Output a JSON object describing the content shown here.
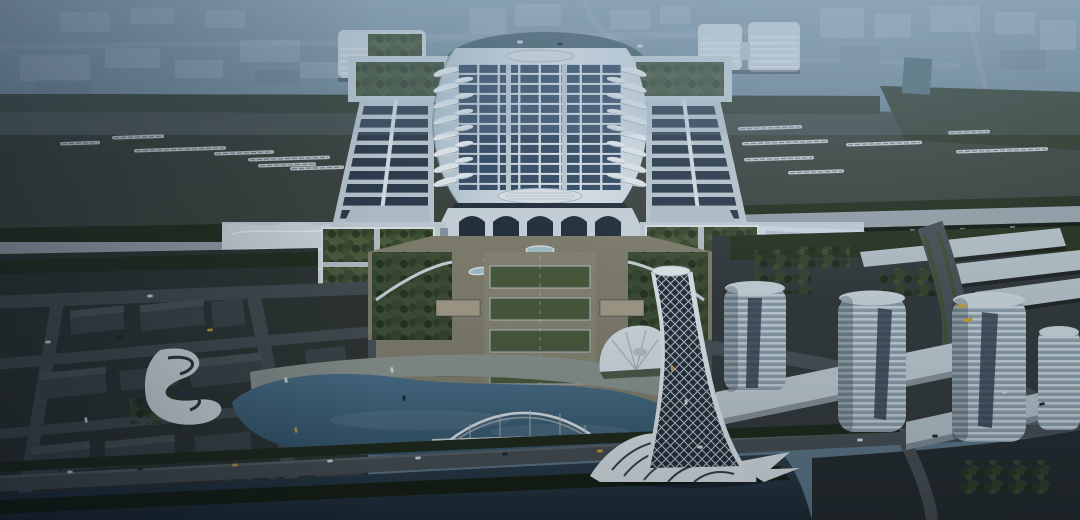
{
  "scene": {
    "title": "Aerial dusk rendering of a high-speed railway station complex",
    "time_of_day": "dusk",
    "description": "Bird's-eye architectural rendering: a huge white station hall with a solar-panel roof flanked by platform canopies and rail yards with white trains; a landscaped axial plaza leads south to a lake with an arched gateway bridge, a twisted white lattice tower, cylindrical towers on podiums to the southeast, low dark city blocks to the southwest, and a hazy city skyline to the north.",
    "landmarks": [
      "station-main-hall",
      "solar-panel-roof",
      "platform-canopies",
      "rail-yards",
      "west-annex",
      "east-annex",
      "axial-plaza",
      "lake",
      "arch-bridge",
      "twist-tower",
      "cylindrical-towers",
      "waterfront-road",
      "river"
    ]
  },
  "palette": {
    "sky_top": "#8fa6b4",
    "sky_low": "#617b8c",
    "rail_bed": "#3c433d",
    "train": "#c7ccd0",
    "viaduct": "#9aa5ac",
    "roof_light": "#e9eff4",
    "roof_mid": "#c6d3dc",
    "solar": "#344a63",
    "canopy_base": "#c2cdd5",
    "canopy_strip": "#2c3a4a",
    "skylight": "#edf2f5",
    "glass": "#232e38",
    "annex": "#c6d1d9",
    "annex_roof": "#d4dde4",
    "court_green": "#4d5d3b",
    "path_light": "#b9c3c9",
    "facade": "#9fabb2",
    "plaza": "#83806d",
    "lawn": "#4a5a3a",
    "garden": "#3f4e33",
    "beige": "#a9a18a",
    "road": "#474e53",
    "road_light": "#5a6166",
    "ground_left": "#2d332f",
    "block": "#3e4549",
    "block_top": "#4e5559",
    "lake_hi": "#4a7089",
    "lake_lo": "#35566b",
    "river_hi": "#2a3d4a",
    "river_lo": "#1c2a34",
    "promenade": "#8d968f",
    "white": "#e2e9ed",
    "tower_base": "#8fa1ad",
    "tower_top": "#cdd8df",
    "podium": "#c3ced5",
    "slab": "#b9c4ca",
    "tree_dark": "#27331f",
    "tree_mid": "#33402a",
    "car_white": "#d9dee1",
    "car_dark": "#20262c",
    "car_yellow": "#c9a23a"
  },
  "trains": [
    {
      "x": 60,
      "y": 142,
      "len": 40
    },
    {
      "x": 112,
      "y": 136,
      "len": 52
    },
    {
      "x": 134,
      "y": 149,
      "len": 92
    },
    {
      "x": 214,
      "y": 152,
      "len": 60
    },
    {
      "x": 248,
      "y": 158,
      "len": 82
    },
    {
      "x": 258,
      "y": 164,
      "len": 58
    },
    {
      "x": 290,
      "y": 167,
      "len": 54
    },
    {
      "x": 738,
      "y": 127,
      "len": 64
    },
    {
      "x": 742,
      "y": 142,
      "len": 86
    },
    {
      "x": 846,
      "y": 143,
      "len": 76
    },
    {
      "x": 948,
      "y": 131,
      "len": 42
    },
    {
      "x": 956,
      "y": 150,
      "len": 92
    },
    {
      "x": 744,
      "y": 158,
      "len": 70
    },
    {
      "x": 788,
      "y": 171,
      "len": 56
    }
  ],
  "station": {
    "skylights": [
      {
        "x": 446,
        "rot": -15,
        "s": 1.0,
        "ys": [
          72,
          88,
          104,
          120,
          136,
          152,
          168,
          182
        ]
      },
      {
        "x": 634,
        "rot": 15,
        "s": 1.0,
        "ys": [
          72,
          88,
          104,
          120,
          136,
          152,
          168,
          182
        ]
      },
      {
        "x": 464,
        "rot": -10,
        "s": 0.72,
        "ys": [
          80,
          96,
          112,
          128,
          144,
          160,
          176
        ]
      },
      {
        "x": 616,
        "rot": 10,
        "s": 0.72,
        "ys": [
          80,
          96,
          112,
          128,
          144,
          160,
          176
        ]
      }
    ]
  },
  "cars": [
    {
      "x": 70,
      "y": 472,
      "r": -3,
      "c": "car_white"
    },
    {
      "x": 140,
      "y": 469,
      "r": -3,
      "c": "car_dark"
    },
    {
      "x": 235,
      "y": 465,
      "r": -3,
      "c": "car_yellow"
    },
    {
      "x": 330,
      "y": 461,
      "r": -3,
      "c": "car_white"
    },
    {
      "x": 418,
      "y": 458,
      "r": -3,
      "c": "car_white"
    },
    {
      "x": 505,
      "y": 454,
      "r": -3,
      "c": "car_dark"
    },
    {
      "x": 600,
      "y": 451,
      "r": -2,
      "c": "car_yellow"
    },
    {
      "x": 700,
      "y": 447,
      "r": -2,
      "c": "car_white"
    },
    {
      "x": 860,
      "y": 440,
      "r": -2,
      "c": "car_white"
    },
    {
      "x": 935,
      "y": 436,
      "r": -2,
      "c": "car_dark"
    },
    {
      "x": 962,
      "y": 306,
      "r": -8,
      "c": "car_yellow",
      "bus": true
    },
    {
      "x": 968,
      "y": 320,
      "r": -8,
      "c": "car_yellow",
      "bus": true
    },
    {
      "x": 1005,
      "y": 392,
      "r": -15,
      "c": "car_white"
    },
    {
      "x": 1042,
      "y": 404,
      "r": -15,
      "c": "car_dark"
    },
    {
      "x": 48,
      "y": 342,
      "r": -5,
      "c": "car_white"
    },
    {
      "x": 120,
      "y": 337,
      "r": -5,
      "c": "car_dark"
    },
    {
      "x": 210,
      "y": 330,
      "r": -5,
      "c": "car_yellow"
    },
    {
      "x": 150,
      "y": 296,
      "r": -5,
      "c": "car_white"
    },
    {
      "x": 86,
      "y": 420,
      "r": 82,
      "c": "car_white"
    },
    {
      "x": 60,
      "y": 468,
      "r": 82,
      "c": "car_dark"
    },
    {
      "x": 286,
      "y": 380,
      "r": 80,
      "c": "car_white"
    },
    {
      "x": 296,
      "y": 430,
      "r": 80,
      "c": "car_yellow"
    },
    {
      "x": 392,
      "y": 370,
      "r": 85,
      "c": "car_white"
    },
    {
      "x": 404,
      "y": 398,
      "r": 85,
      "c": "car_dark"
    },
    {
      "x": 672,
      "y": 368,
      "r": 85,
      "c": "car_yellow"
    },
    {
      "x": 686,
      "y": 402,
      "r": 85,
      "c": "car_white"
    },
    {
      "x": 520,
      "y": 42,
      "r": -2,
      "c": "car_white"
    },
    {
      "x": 560,
      "y": 44,
      "r": -2,
      "c": "car_dark"
    },
    {
      "x": 640,
      "y": 46,
      "r": -2,
      "c": "car_white"
    }
  ]
}
